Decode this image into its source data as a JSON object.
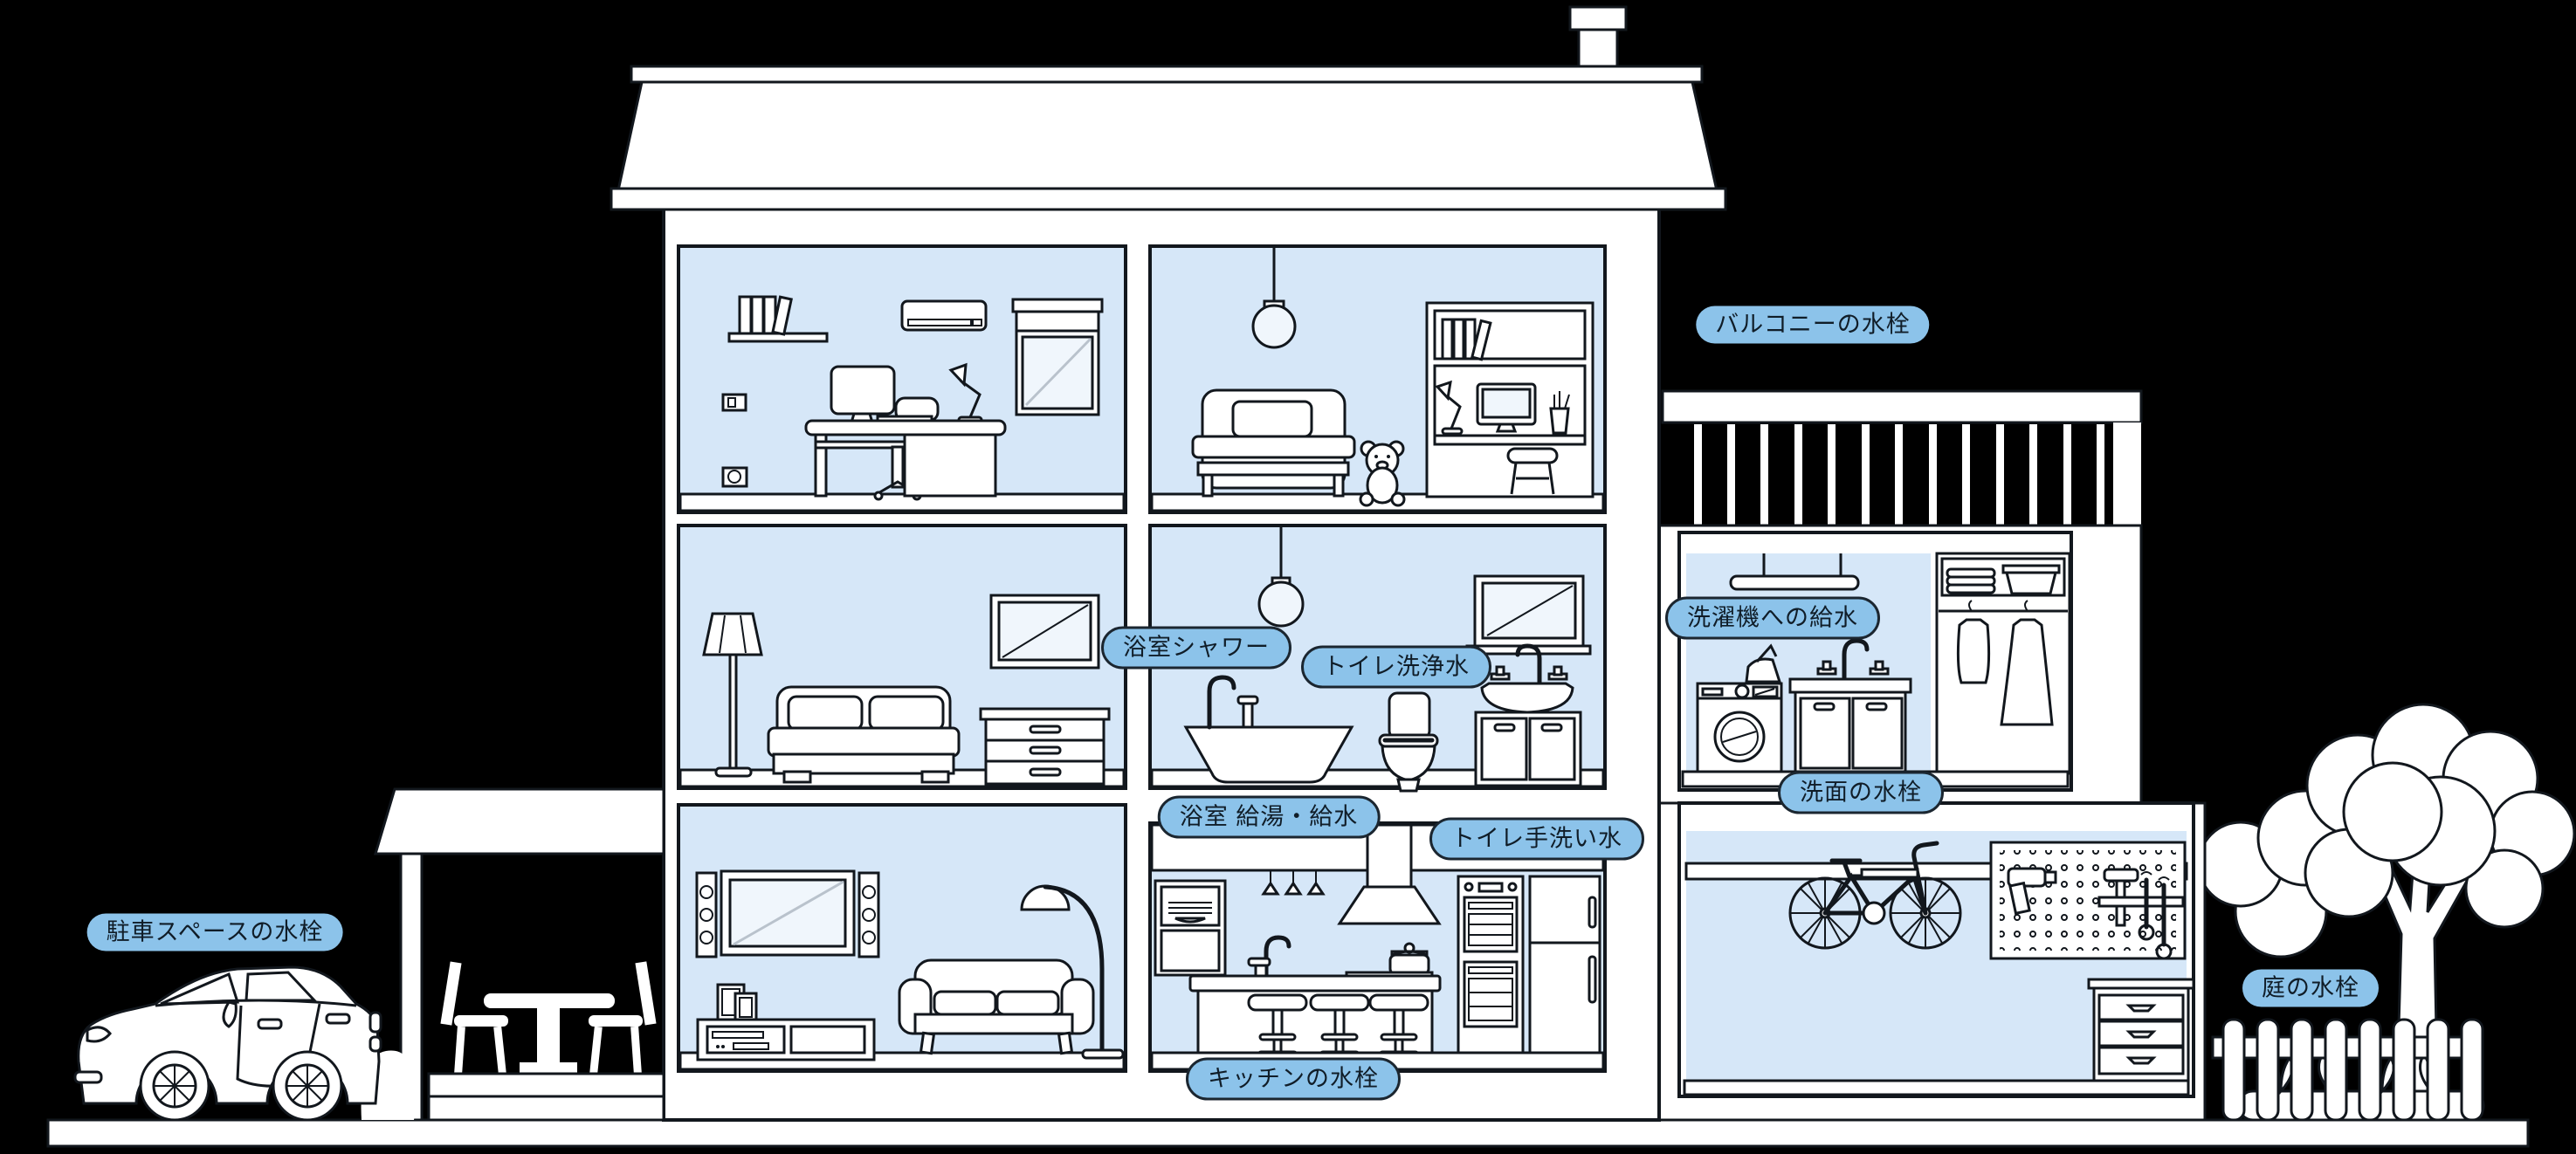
{
  "diagram": {
    "type": "house-cross-section-water-fixture-map",
    "labels": [
      {
        "id": "parking",
        "text": "駐車スペースの水栓"
      },
      {
        "id": "balcony",
        "text": "バルコニーの水栓"
      },
      {
        "id": "bath-shower",
        "text": "浴室シャワー"
      },
      {
        "id": "toilet-flush",
        "text": "トイレ洗浄水"
      },
      {
        "id": "washer-supply",
        "text": "洗濯機への給水"
      },
      {
        "id": "bath-supply",
        "text": "浴室 給湯・給水"
      },
      {
        "id": "toilet-hand",
        "text": "トイレ手洗い水"
      },
      {
        "id": "washbasin",
        "text": "洗面の水栓"
      },
      {
        "id": "kitchen",
        "text": "キッチンの水栓"
      },
      {
        "id": "garden",
        "text": "庭の水栓"
      }
    ],
    "colors": {
      "background": "#000000",
      "outline": "#12171d",
      "room_fill": "#d6e7f8",
      "label_fill": "#8cc3ea",
      "label_border": "#1b2630",
      "label_text": "#101d28",
      "house_fill": "#ffffff",
      "diagonal_gray": "#b9c2cc"
    }
  }
}
